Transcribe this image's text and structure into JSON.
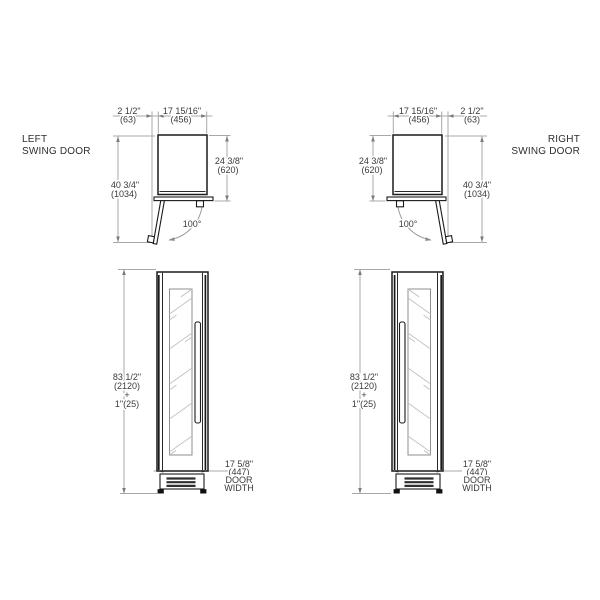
{
  "document": {
    "type": "appliance installation dimension drawing",
    "background": "#ffffff"
  },
  "colors": {
    "object_line": "#1a1a1a",
    "dimension_line": "#a8a8a8",
    "text": "#3a3a3a"
  },
  "views": {
    "top_left": {
      "title": [
        "LEFT",
        "SWING DOOR"
      ],
      "dim_clearance": [
        "2 1/2\"",
        "(63)"
      ],
      "dim_width": [
        "17 15/16\"",
        "(456)"
      ],
      "dim_depth": [
        "24 3/8\"",
        "(620)"
      ],
      "dim_total": [
        "40 3/4\"",
        "(1034)"
      ],
      "angle": "100°"
    },
    "top_right": {
      "title": [
        "RIGHT",
        "SWING DOOR"
      ],
      "dim_width": [
        "17 15/16\"",
        "(456)"
      ],
      "dim_clearance": [
        "2 1/2\"",
        "(63)"
      ],
      "dim_depth": [
        "24 3/8\"",
        "(620)"
      ],
      "dim_total": [
        "40 3/4\"",
        "(1034)"
      ],
      "angle": "100°"
    },
    "front_left": {
      "dim_height": [
        "83 1/2\"",
        "(2120)",
        "+",
        "1\"(25)"
      ],
      "dim_door_width": [
        "17 5/8\"",
        "(447)",
        "DOOR",
        "WIDTH"
      ]
    },
    "front_right": {
      "dim_height": [
        "83 1/2\"",
        "(2120)",
        "+",
        "1\"(25)"
      ],
      "dim_door_width": [
        "17 5/8\"",
        "(447)",
        "DOOR",
        "WIDTH"
      ]
    }
  }
}
